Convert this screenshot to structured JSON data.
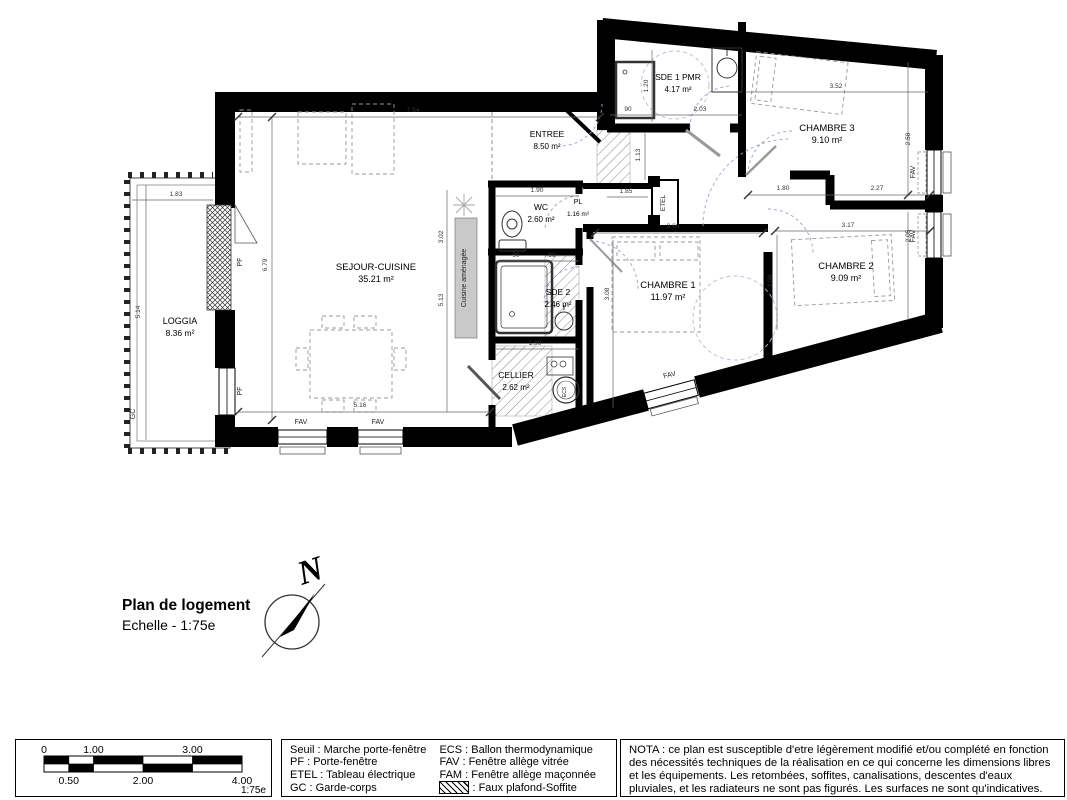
{
  "title_block": {
    "title": "Plan de logement",
    "scale": "Echelle - 1:75e"
  },
  "compass": {
    "north_label": "N"
  },
  "plan": {
    "rooms": [
      {
        "name": "LOGGIA",
        "area": "8.36 m²",
        "x": 180,
        "y": 324,
        "size": 9
      },
      {
        "name": "SEJOUR-CUISINE",
        "area": "35.21 m²",
        "x": 376,
        "y": 270,
        "size": 9.5
      },
      {
        "name": "ENTREE",
        "area": "8.50 m²",
        "x": 547,
        "y": 137,
        "size": 8.5
      },
      {
        "name": "WC",
        "area": "2.60 m²",
        "x": 541,
        "y": 210,
        "size": 8.5
      },
      {
        "name": "PL",
        "area": "1.16 m²",
        "x": 578,
        "y": 204,
        "size": 7
      },
      {
        "name": "SDE 1 PMR",
        "area": "4.17 m²",
        "x": 678,
        "y": 80,
        "size": 8.5
      },
      {
        "name": "CHAMBRE 3",
        "area": "9.10 m²",
        "x": 827,
        "y": 131,
        "size": 9.5
      },
      {
        "name": "CHAMBRE 2",
        "area": "9.09 m²",
        "x": 846,
        "y": 269,
        "size": 9.5
      },
      {
        "name": "CHAMBRE 1",
        "area": "11.97 m²",
        "x": 668,
        "y": 288,
        "size": 9.5
      },
      {
        "name": "SDE 2",
        "area": "2.46 m²",
        "x": 558,
        "y": 295,
        "size": 8.5
      },
      {
        "name": "CELLIER",
        "area": "2.62 m²",
        "x": 516,
        "y": 378,
        "size": 8.5
      }
    ],
    "annotations": [
      {
        "text": "Cuisine aménagée",
        "x": 466,
        "y": 278,
        "rot": -90,
        "size": 7
      },
      {
        "text": "ETEL",
        "x": 665,
        "y": 203,
        "rot": -90,
        "size": 6.5
      },
      {
        "text": "PF",
        "x": 242,
        "y": 262,
        "rot": -90,
        "size": 7
      },
      {
        "text": "PF",
        "x": 242,
        "y": 391,
        "rot": -90,
        "size": 7
      },
      {
        "text": "GC",
        "x": 135,
        "y": 414,
        "rot": -90,
        "size": 7
      },
      {
        "text": "FAV",
        "x": 915,
        "y": 172,
        "rot": -90,
        "size": 7
      },
      {
        "text": "FAV",
        "x": 915,
        "y": 236,
        "rot": -90,
        "size": 7
      },
      {
        "text": "FAV",
        "x": 301,
        "y": 424,
        "rot": 0,
        "size": 7
      },
      {
        "text": "FAV",
        "x": 378,
        "y": 424,
        "rot": 0,
        "size": 7
      },
      {
        "text": "FAV",
        "x": 670,
        "y": 377,
        "rot": -13,
        "size": 7
      },
      {
        "text": "ECS",
        "x": 566,
        "y": 392,
        "rot": -90,
        "size": 5
      }
    ],
    "dimensions": [
      {
        "value": "7.54",
        "x": 413,
        "y": 112,
        "rot": 0
      },
      {
        "value": "1.83",
        "x": 176,
        "y": 196,
        "rot": 0
      },
      {
        "value": "5.14",
        "x": 140,
        "y": 312,
        "rot": -90
      },
      {
        "value": "6.79",
        "x": 267,
        "y": 265,
        "rot": -90
      },
      {
        "value": "3.02",
        "x": 443,
        "y": 237,
        "rot": -90
      },
      {
        "value": "5.13",
        "x": 443,
        "y": 300,
        "rot": -90
      },
      {
        "value": "5.16",
        "x": 360,
        "y": 407,
        "rot": 0
      },
      {
        "value": "1.90",
        "x": 537,
        "y": 192,
        "rot": 0
      },
      {
        "value": "90",
        "x": 516,
        "y": 257,
        "rot": 0
      },
      {
        "value": "90",
        "x": 552,
        "y": 257,
        "rot": 0
      },
      {
        "value": "1.90",
        "x": 535,
        "y": 345,
        "rot": 0
      },
      {
        "value": "3.60",
        "x": 673,
        "y": 228,
        "rot": 0
      },
      {
        "value": "3.08",
        "x": 609,
        "y": 294,
        "rot": -90
      },
      {
        "value": "1.85",
        "x": 626,
        "y": 193,
        "rot": 0
      },
      {
        "value": "1.80",
        "x": 783,
        "y": 190,
        "rot": 0
      },
      {
        "value": "2.27",
        "x": 877,
        "y": 190,
        "rot": 0
      },
      {
        "value": "3.52",
        "x": 836,
        "y": 88,
        "rot": 0
      },
      {
        "value": "2.03",
        "x": 700,
        "y": 111,
        "rot": 0
      },
      {
        "value": "90",
        "x": 628,
        "y": 111,
        "rot": 0
      },
      {
        "value": "1.20",
        "x": 648,
        "y": 86,
        "rot": -90
      },
      {
        "value": "1.13",
        "x": 640,
        "y": 155,
        "rot": -90
      },
      {
        "value": "2.58",
        "x": 910,
        "y": 139,
        "rot": -90
      },
      {
        "value": "2.05",
        "x": 910,
        "y": 236,
        "rot": -90
      },
      {
        "value": "3.17",
        "x": 848,
        "y": 227,
        "rot": 0
      },
      {
        "value": "2.08",
        "x": 772,
        "y": 281,
        "rot": -90
      }
    ]
  },
  "scale_bar": {
    "top_labels": [
      "0",
      "1.00",
      "3.00"
    ],
    "bottom_labels": [
      "0.50",
      "2.00",
      "4.00"
    ],
    "scale_note": "1:75e"
  },
  "legend": {
    "column1": [
      "Seuil : Marche porte-fenêtre",
      "PF : Porte-fenêtre",
      "ETEL : Tableau électrique",
      "GC : Garde-corps"
    ],
    "column2": [
      "ECS : Ballon thermodynamique",
      "FAV : Fenêtre allège vitrée",
      "FAM : Fenêtre allège maçonnée"
    ],
    "hatch_item": ": Faux plafond-Soffite"
  },
  "nota": "NOTA : ce plan est susceptible d'etre légèrement modifié et/ou complété en fonction des nécessités techniques de la réalisation en ce qui concerne les dimensions libres et les équipements. Les retombées, soffites, canalisations, descentes d'eaux pluviales, et les radiateurs ne sont pas figurés. Les surfaces ne sont qu'indicatives."
}
